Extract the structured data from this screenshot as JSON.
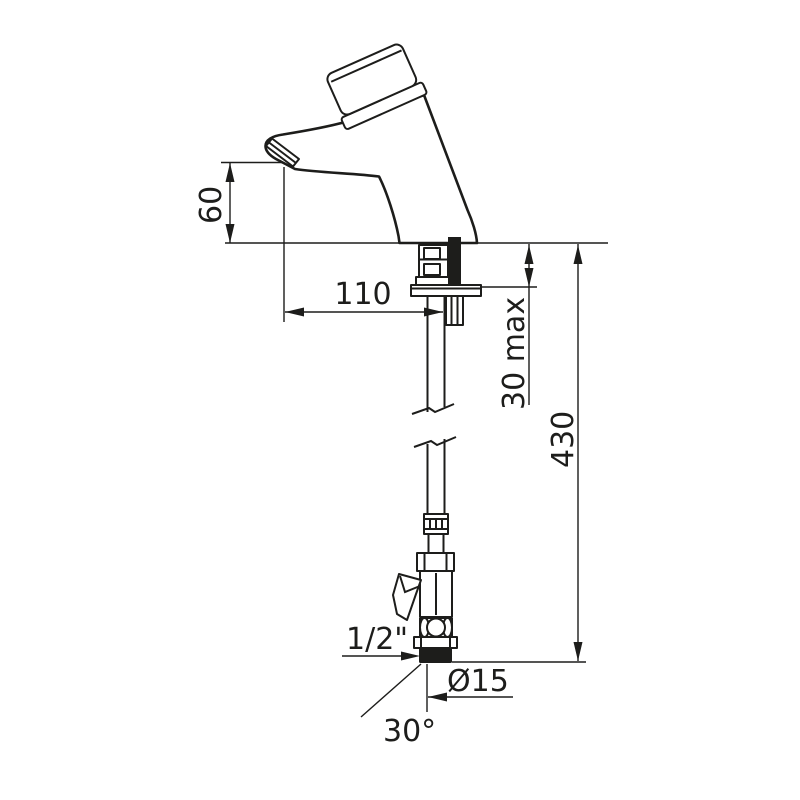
{
  "drawing": {
    "type": "technical-dimension-drawing",
    "subject": "self-closing basin tap with flexible supply hose and angled stop valve",
    "background_color": "#ffffff",
    "line_color": "#1d1d1b",
    "dimensions": {
      "spout_height": "60",
      "spout_reach": "110",
      "deck_thickness_max": "30 max",
      "under_deck_height": "430",
      "inlet_thread": "1/2\"",
      "supply_pipe_diameter": "Ø15",
      "stop_valve_angle": "30°"
    }
  }
}
